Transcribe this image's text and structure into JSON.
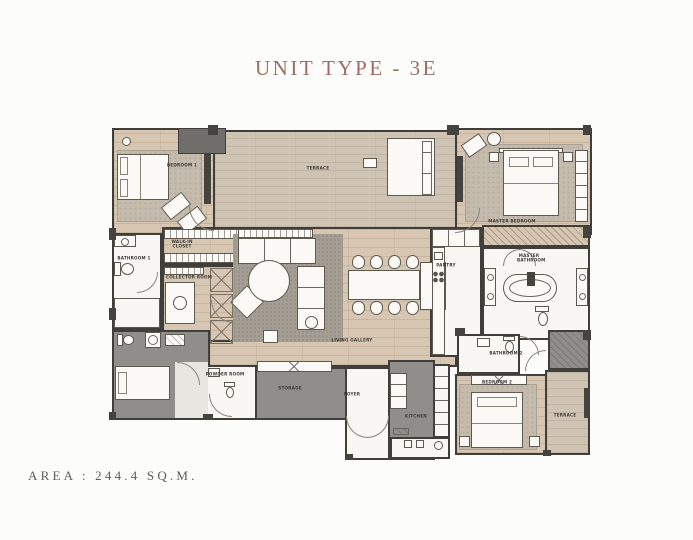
{
  "title": "UNIT TYPE - 3E",
  "area_text": "AREA : 244.4 SQ.M.",
  "plan": {
    "rooms": {
      "bedroom1": "BEDROOM 1",
      "terrace_top": "TERRACE",
      "master_bedroom": "MASTER BEDROOM",
      "walkin_closet": "WALK-IN CLOSET",
      "bathroom1": "BATHROOM 1",
      "collector_room": "COLLECTOR ROOM",
      "living_gallery": "LIVING GALLERY",
      "pantry": "PANTRY",
      "master_bathroom": "MASTER BATHROOM",
      "bathroom2": "BATHROOM 2",
      "bedroom2": "BEDROOM 2",
      "terrace_side": "TERRACE",
      "powder_room": "POWDER ROOM",
      "storage": "STORAGE",
      "foyer": "FOYER",
      "kitchen": "KITCHEN"
    }
  },
  "colors": {
    "title_text": "#9c6d62",
    "area_text": "#5d5d5d",
    "wall": "#403e3a",
    "wood_floor": "#d7c7b2",
    "terrace_floor": "#cfc4b4",
    "white_room": "#f8f7f4",
    "gray_room": "#8f8e8b",
    "carpet": "#c4bbad",
    "page_bg": "#fcfcfa"
  }
}
